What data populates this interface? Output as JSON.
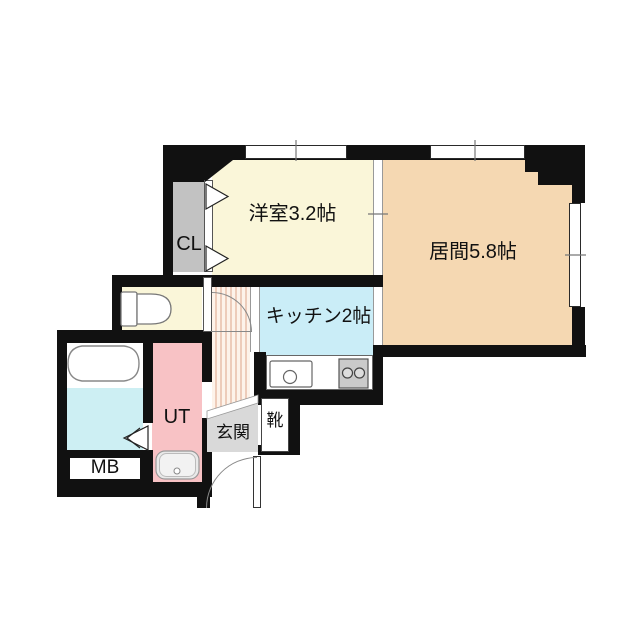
{
  "plan": {
    "rooms": {
      "closet": {
        "label": "CL",
        "color": "#C2C2C2"
      },
      "western_room": {
        "label": "洋室3.2帖",
        "color": "#FAF6D9"
      },
      "living_room": {
        "label": "居間5.8帖",
        "color": "#F5D8B2"
      },
      "kitchen": {
        "label": "キッチン2帖",
        "color": "#CAEDF7"
      },
      "utility": {
        "label": "UT",
        "color": "#F8C2C5"
      },
      "meter_box": {
        "label": "MB",
        "color": "#FFFFFF"
      },
      "entrance": {
        "label": "玄関",
        "color": "#D9D9D9"
      },
      "shoe_cabinet": {
        "label": "靴",
        "color": "#FFFFFF"
      },
      "toilet_room": {
        "color": "#FAF6D9"
      },
      "bathroom_floor": {
        "color": "#CDEFF3"
      }
    },
    "wall_color": "#111111"
  }
}
